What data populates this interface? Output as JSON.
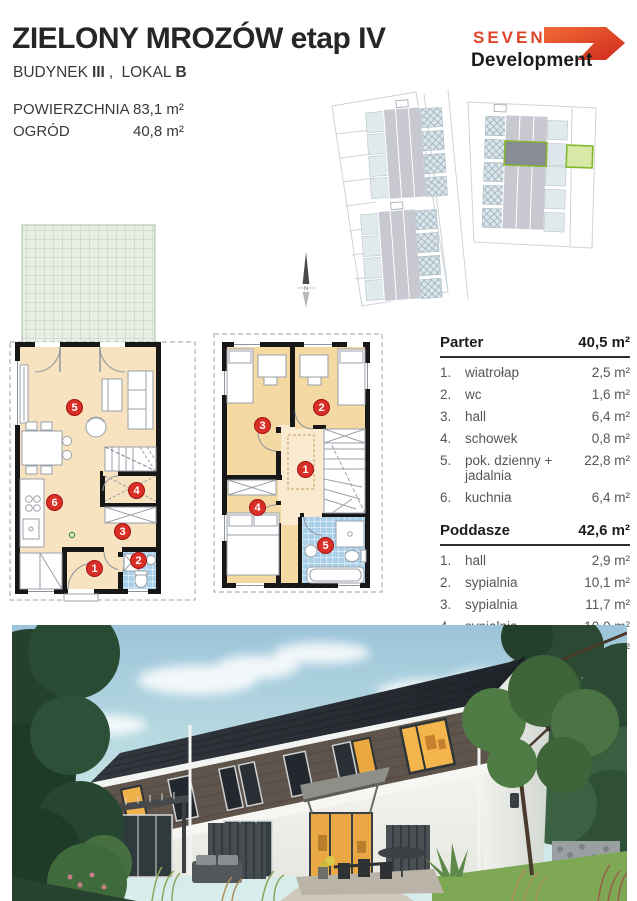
{
  "header": {
    "title": "ZIELONY MROZÓW etap IV",
    "subtitle": {
      "b1": "BUDYNEK",
      "v1": "III",
      "sep": ", ",
      "b2": "LOKAL",
      "v2": "B"
    },
    "specs": [
      {
        "label": "POWIERZCHNIA",
        "value": "83,1 m²"
      },
      {
        "label": "OGRÓD",
        "value": "40,8 m²"
      }
    ]
  },
  "logo": {
    "line1": "SEVEN",
    "line2": "Development"
  },
  "site_plan": {
    "north_label": "N"
  },
  "plans": {
    "parter_badges": [
      "1",
      "2",
      "3",
      "4",
      "5",
      "6"
    ],
    "poddasze_badges": [
      "1",
      "2",
      "3",
      "4",
      "5"
    ]
  },
  "tables": [
    {
      "name": "Parter",
      "total": "40,5 m²",
      "rows": [
        {
          "no": "1.",
          "room": "wiatrołap",
          "area": "2,5 m²"
        },
        {
          "no": "2.",
          "room": "wc",
          "area": "1,6 m²"
        },
        {
          "no": "3.",
          "room": "hall",
          "area": "6,4 m²"
        },
        {
          "no": "4.",
          "room": "schowek",
          "area": "0,8 m²"
        },
        {
          "no": "5.",
          "room": "pok. dzienny + jadalnia",
          "area": "22,8 m²"
        },
        {
          "no": "6.",
          "room": "kuchnia",
          "area": "6,4 m²"
        }
      ]
    },
    {
      "name": "Poddasze",
      "total": "42,6 m²",
      "rows": [
        {
          "no": "1.",
          "room": "hall",
          "area": "2,9 m²"
        },
        {
          "no": "2.",
          "room": "sypialnia",
          "area": "10,1 m²"
        },
        {
          "no": "3.",
          "room": "sypialnia",
          "area": "11,7 m²"
        },
        {
          "no": "4.",
          "room": "sypialnia",
          "area": "10,0 m²"
        },
        {
          "no": "5.",
          "room": "łazienka",
          "area": "7,9 m²"
        }
      ]
    }
  ],
  "colors": {
    "badge_red": "#d92f27",
    "plan_cream": "#f7e3c0",
    "plan_beige": "#f4d9a3",
    "bath_blue": "#aacfe9",
    "highlight_green": "#85b72e",
    "logo_red": "#e0452c"
  }
}
